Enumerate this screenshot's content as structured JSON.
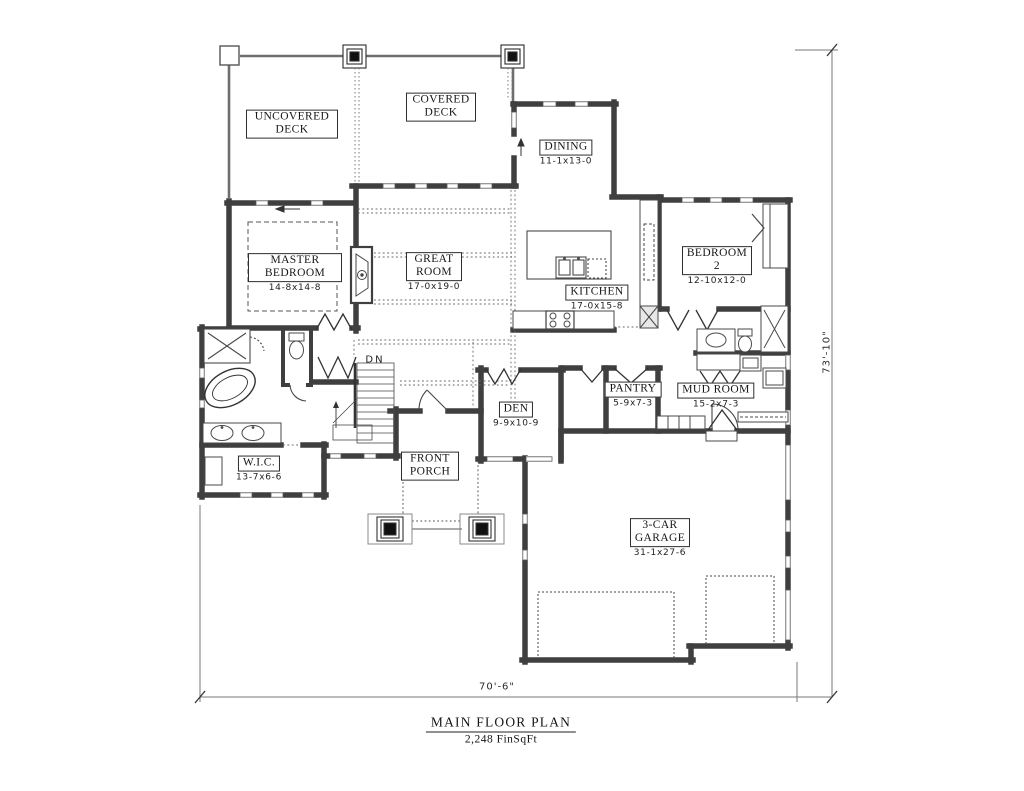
{
  "rooms": {
    "uncovered_deck": {
      "name": "UNCOVERED DECK"
    },
    "covered_deck": {
      "name": "COVERED DECK"
    },
    "dining": {
      "name": "DINING",
      "dims": "11-1x13-0"
    },
    "master_bedroom": {
      "name": "MASTER BEDROOM",
      "dims": "14-8x14-8"
    },
    "great_room": {
      "name": "GREAT ROOM",
      "dims": "17-0x19-0"
    },
    "kitchen": {
      "name": "KITCHEN",
      "dims": "17-0x15-8"
    },
    "bedroom_2": {
      "name": "BEDROOM 2",
      "dims": "12-10x12-0"
    },
    "den": {
      "name": "DEN",
      "dims": "9-9x10-9"
    },
    "pantry": {
      "name": "PANTRY",
      "dims": "5-9x7-3"
    },
    "mud_room": {
      "name": "MUD ROOM",
      "dims": "15-2x7-3"
    },
    "wic": {
      "name": "W.I.C.",
      "dims": "13-7x6-6"
    },
    "front_porch": {
      "name": "FRONT PORCH"
    },
    "garage": {
      "name": "3-CAR GARAGE",
      "dims": "31-1x27-6"
    }
  },
  "annotations": {
    "stairs_direction": "DN",
    "height_dim": "73'-10\"",
    "width_dim": "70'-6\""
  },
  "title": {
    "main": "MAIN FLOOR PLAN",
    "sub": "2,248 FinSqFt"
  },
  "colors": {
    "wall": "#3f3f3f",
    "deck": "#6e6e6e",
    "dotted": "#666666"
  }
}
